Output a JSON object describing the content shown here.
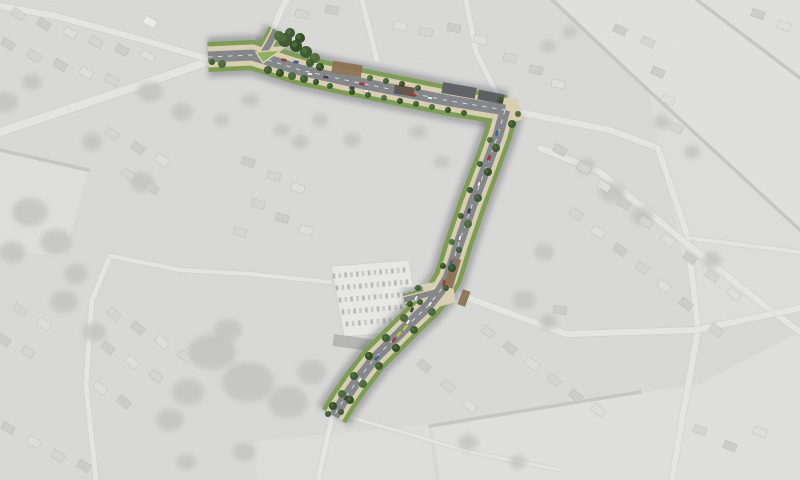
{
  "meta": {
    "description": "Greyscale aerial photograph of a village with a coloured landscape masterplan overlay of a proposed street corridor",
    "width": 800,
    "height": 480
  },
  "background": {
    "base": "#cfcfcd",
    "wash_color": "#ffffff",
    "wash_opacity": 0.26,
    "fields": [
      {
        "pts": "556,0 800,0 800,228 648,88",
        "fill": "#dadad8"
      },
      {
        "pts": "648,88 800,228 800,312 700,330 660,150",
        "fill": "#d6d6d4"
      },
      {
        "pts": "432,424 700,384 800,332 800,480 440,480",
        "fill": "#d9d9d7"
      },
      {
        "pts": "252,442 428,424 436,480 258,480",
        "fill": "#d6d6d4"
      },
      {
        "pts": "0,152 88,172 64,258 0,248",
        "fill": "#d8d8d6"
      }
    ],
    "hedges": [
      "M 552 0 L 646 88",
      "M 646 88 L 800 230",
      "M 697 0 L 800 78",
      "M 0 150 L 88 170",
      "M 430 426 L 640 392"
    ],
    "hedge_color": "#aeaeac",
    "roads": [
      {
        "d": "M 0 132 L 140 85 L 212 60",
        "w": 8
      },
      {
        "d": "M 212 60 L 150 42 L 56 16 L 0 6",
        "w": 6
      },
      {
        "d": "M 272 32 L 282 8 L 287 0",
        "w": 6
      },
      {
        "d": "M 362 0 L 377 60",
        "w": 5
      },
      {
        "d": "M 466 0 L 476 52 L 498 96",
        "w": 5
      },
      {
        "d": "M 518 112 L 610 130 L 658 148",
        "w": 6
      },
      {
        "d": "M 658 148 L 688 238 L 698 330 L 682 420 L 672 480",
        "w": 6
      },
      {
        "d": "M 540 148 L 600 172 L 680 238 L 760 302 L 800 332",
        "w": 6
      },
      {
        "d": "M 452 292 L 566 334 L 696 330 L 800 308",
        "w": 6
      },
      {
        "d": "M 688 238 L 800 252",
        "w": 4
      },
      {
        "d": "M 96 480 L 86 384 L 92 300 L 110 256",
        "w": 5
      },
      {
        "d": "M 110 256 L 180 270 L 250 274 L 330 282",
        "w": 4
      },
      {
        "d": "M 332 418 L 318 480",
        "w": 5
      },
      {
        "d": "M 340 414 L 470 452 L 560 470",
        "w": 3
      }
    ],
    "road_fill": "#e2e2e0",
    "road_casing": "#bdbdbb",
    "tree_blobs": [
      [
        212,
        352,
        24,
        18
      ],
      [
        248,
        382,
        26,
        20
      ],
      [
        288,
        402,
        20,
        16
      ],
      [
        312,
        372,
        15,
        12
      ],
      [
        228,
        330,
        14,
        11
      ],
      [
        188,
        392,
        16,
        13
      ],
      [
        170,
        420,
        14,
        11
      ],
      [
        30,
        212,
        18,
        14
      ],
      [
        56,
        242,
        16,
        13
      ],
      [
        12,
        252,
        13,
        11
      ],
      [
        76,
        274,
        12,
        10
      ],
      [
        150,
        92,
        13,
        10
      ],
      [
        182,
        112,
        11,
        9
      ],
      [
        142,
        182,
        12,
        10
      ],
      [
        92,
        142,
        10,
        9
      ],
      [
        612,
        192,
        13,
        10
      ],
      [
        642,
        216,
        11,
        9
      ],
      [
        586,
        166,
        9,
        8
      ],
      [
        544,
        252,
        10,
        8
      ],
      [
        524,
        300,
        12,
        9
      ],
      [
        548,
        322,
        9,
        8
      ],
      [
        662,
        122,
        8,
        7
      ],
      [
        692,
        152,
        8,
        7
      ],
      [
        712,
        260,
        9,
        8
      ],
      [
        468,
        442,
        10,
        8
      ],
      [
        518,
        462,
        8,
        7
      ],
      [
        244,
        452,
        12,
        9
      ],
      [
        186,
        462,
        10,
        8
      ],
      [
        64,
        302,
        14,
        11
      ],
      [
        94,
        332,
        12,
        9
      ],
      [
        6,
        102,
        12,
        10
      ],
      [
        32,
        82,
        10,
        8
      ],
      [
        418,
        132,
        9,
        7
      ],
      [
        442,
        162,
        8,
        6
      ],
      [
        548,
        46,
        8,
        6
      ],
      [
        570,
        32,
        7,
        6
      ],
      [
        352,
        140,
        9,
        7
      ],
      [
        320,
        120,
        8,
        6
      ],
      [
        250,
        100,
        9,
        7
      ],
      [
        222,
        120,
        8,
        6
      ],
      [
        282,
        130,
        8,
        6
      ],
      [
        300,
        142,
        9,
        7
      ]
    ],
    "blob_color": "#a7a7a5",
    "house_size": [
      13,
      8
    ],
    "house_fills": [
      "#c9c9c7",
      "#bcbcba",
      "#d8d8d6",
      "#ececea"
    ],
    "houses": [
      [
        18,
        14,
        32,
        0
      ],
      [
        44,
        24,
        32,
        1
      ],
      [
        70,
        33,
        30,
        2
      ],
      [
        96,
        42,
        30,
        0
      ],
      [
        122,
        50,
        28,
        1
      ],
      [
        148,
        56,
        28,
        2
      ],
      [
        8,
        44,
        32,
        1
      ],
      [
        34,
        56,
        30,
        0
      ],
      [
        60,
        65,
        30,
        1
      ],
      [
        86,
        73,
        28,
        2
      ],
      [
        112,
        80,
        28,
        0
      ],
      [
        150,
        22,
        30,
        3
      ],
      [
        302,
        14,
        10,
        0
      ],
      [
        332,
        10,
        10,
        1
      ],
      [
        400,
        26,
        10,
        2
      ],
      [
        426,
        32,
        10,
        0
      ],
      [
        454,
        28,
        10,
        1
      ],
      [
        480,
        40,
        12,
        2
      ],
      [
        510,
        58,
        12,
        0
      ],
      [
        536,
        70,
        12,
        1
      ],
      [
        558,
        84,
        12,
        2
      ],
      [
        648,
        42,
        25,
        0
      ],
      [
        658,
        72,
        25,
        1
      ],
      [
        668,
        100,
        25,
        2
      ],
      [
        676,
        128,
        25,
        0
      ],
      [
        758,
        14,
        20,
        1
      ],
      [
        784,
        26,
        20,
        2
      ],
      [
        620,
        30,
        25,
        1
      ],
      [
        112,
        134,
        35,
        0
      ],
      [
        138,
        148,
        35,
        1
      ],
      [
        162,
        160,
        33,
        2
      ],
      [
        128,
        174,
        33,
        0
      ],
      [
        152,
        188,
        33,
        1
      ],
      [
        248,
        162,
        15,
        1
      ],
      [
        274,
        176,
        15,
        0
      ],
      [
        298,
        188,
        15,
        2
      ],
      [
        258,
        204,
        15,
        0
      ],
      [
        282,
        218,
        15,
        1
      ],
      [
        306,
        230,
        15,
        2
      ],
      [
        240,
        232,
        15,
        0
      ],
      [
        560,
        150,
        30,
        1
      ],
      [
        584,
        168,
        30,
        0
      ],
      [
        604,
        186,
        32,
        2
      ],
      [
        624,
        204,
        32,
        1
      ],
      [
        646,
        222,
        34,
        0
      ],
      [
        668,
        240,
        34,
        2
      ],
      [
        690,
        258,
        36,
        1
      ],
      [
        712,
        276,
        36,
        0
      ],
      [
        734,
        294,
        38,
        2
      ],
      [
        576,
        214,
        32,
        0
      ],
      [
        598,
        232,
        32,
        2
      ],
      [
        620,
        250,
        34,
        1
      ],
      [
        642,
        268,
        34,
        0
      ],
      [
        664,
        286,
        36,
        2
      ],
      [
        686,
        304,
        36,
        1
      ],
      [
        716,
        330,
        38,
        0
      ],
      [
        560,
        310,
        10,
        1
      ],
      [
        488,
        332,
        40,
        0
      ],
      [
        510,
        348,
        40,
        1
      ],
      [
        532,
        364,
        40,
        2
      ],
      [
        554,
        380,
        40,
        0
      ],
      [
        576,
        396,
        38,
        1
      ],
      [
        598,
        410,
        38,
        2
      ],
      [
        700,
        430,
        20,
        0
      ],
      [
        730,
        446,
        20,
        1
      ],
      [
        760,
        432,
        20,
        2
      ],
      [
        424,
        366,
        40,
        1
      ],
      [
        448,
        386,
        40,
        0
      ],
      [
        470,
        406,
        40,
        2
      ],
      [
        114,
        314,
        40,
        0
      ],
      [
        138,
        328,
        40,
        1
      ],
      [
        162,
        342,
        40,
        2
      ],
      [
        184,
        356,
        40,
        0
      ],
      [
        108,
        348,
        40,
        1
      ],
      [
        132,
        362,
        40,
        2
      ],
      [
        156,
        376,
        40,
        0
      ],
      [
        100,
        388,
        40,
        2
      ],
      [
        124,
        402,
        40,
        1
      ],
      [
        20,
        310,
        35,
        0
      ],
      [
        44,
        324,
        35,
        2
      ],
      [
        4,
        340,
        35,
        1
      ],
      [
        28,
        352,
        35,
        0
      ],
      [
        8,
        428,
        30,
        1
      ],
      [
        34,
        442,
        30,
        2
      ],
      [
        58,
        456,
        30,
        0
      ],
      [
        84,
        466,
        30,
        1
      ]
    ]
  },
  "car_park": {
    "outline": "331,266 409,260 421,330 344,337",
    "fill": "#e6e6e4",
    "edge": "#c2c2c0",
    "row_car_size": [
      2.6,
      5
    ],
    "row_fills": [
      "#9b9b99",
      "#b7b7b5"
    ],
    "rows": [
      [
        334,
        276,
        404,
        270,
        13
      ],
      [
        337,
        288,
        407,
        282,
        13
      ],
      [
        340,
        300,
        410,
        294,
        13
      ],
      [
        343,
        312,
        413,
        306,
        13
      ],
      [
        347,
        324,
        415,
        318,
        12
      ]
    ],
    "structures": [
      [
        333,
        338,
        58,
        12,
        8,
        "#8f8f8d"
      ]
    ]
  },
  "corridor": {
    "colors": {
      "shadow": "#54565a",
      "green": "#7e9c55",
      "path": "#d8cfb2",
      "road": "#85878a",
      "centerline": "#f0f0ee",
      "island": "#8fb05e",
      "brown": "#8c7356"
    },
    "segments": [
      {
        "name": "main-street",
        "d": "M 208 57 L 252 55 L 300 70 L 350 81 L 400 91 L 450 101 L 505 110",
        "green": 30,
        "path": 21,
        "road": 11,
        "dash": true
      },
      {
        "name": "north-arm",
        "d": "M 262 56 L 270 42 L 276 30",
        "green": 16,
        "path": 10,
        "road": 6.5,
        "dash": false
      },
      {
        "name": "south-road",
        "d": "M 505 110 L 498 135 L 486 168 L 472 205 L 459 243 L 448 278 L 440 291 L 428 306 L 410 323 L 392 341 L 374 359 L 357 381 L 343 401 L 334 416",
        "green": 28,
        "path": 19,
        "road": 10.5,
        "dash": true
      },
      {
        "name": "car-park-arm",
        "d": "M 440 291 L 404 300",
        "green": 12,
        "path": 8,
        "road": 5.5,
        "dash": false
      }
    ],
    "plazas": [
      "488,96 518,99 523,120 497,124",
      "422,284 452,280 456,302 427,310",
      "250,48 287,46 262,66"
    ],
    "island": "256,52 281,50 263,63",
    "brown_patches": [
      [
        332,
        63,
        30,
        12,
        9
      ],
      [
        448,
        258,
        9,
        30,
        17
      ],
      [
        460,
        290,
        8,
        16,
        20
      ]
    ],
    "buildings": [
      [
        442,
        85,
        34,
        11,
        10,
        "#606266"
      ],
      [
        394,
        86,
        20,
        9,
        10,
        "#6b564c"
      ],
      [
        478,
        92,
        26,
        10,
        11,
        "#5d5f62"
      ]
    ],
    "tree_fills": [
      "#3f5c35",
      "#4d6c3e",
      "#335029"
    ],
    "trees": [
      [
        285,
        40,
        7,
        0
      ],
      [
        296,
        46,
        6,
        2
      ],
      [
        306,
        52,
        6,
        0
      ],
      [
        315,
        58,
        5,
        1
      ],
      [
        290,
        33,
        5,
        0
      ],
      [
        300,
        38,
        5,
        2
      ],
      [
        279,
        36,
        5,
        1
      ],
      [
        310,
        63,
        4,
        0
      ],
      [
        320,
        67,
        4,
        2
      ],
      [
        222,
        64,
        4,
        1
      ],
      [
        212,
        62,
        3,
        0
      ],
      [
        268,
        70,
        4,
        0
      ],
      [
        280,
        73,
        4,
        2
      ],
      [
        292,
        76,
        4,
        1
      ],
      [
        304,
        79,
        4,
        0
      ],
      [
        316,
        82,
        3,
        2
      ],
      [
        330,
        86,
        3,
        0
      ],
      [
        370,
        78,
        3,
        1
      ],
      [
        386,
        81,
        3,
        0
      ],
      [
        402,
        84,
        3,
        2
      ],
      [
        418,
        88,
        3,
        0
      ],
      [
        500,
        100,
        3,
        2
      ],
      [
        352,
        92,
        3,
        2
      ],
      [
        368,
        95,
        3,
        0
      ],
      [
        384,
        98,
        3,
        1
      ],
      [
        400,
        101,
        3,
        2
      ],
      [
        416,
        104,
        3,
        0
      ],
      [
        432,
        107,
        3,
        1
      ],
      [
        448,
        110,
        3,
        2
      ],
      [
        464,
        113,
        3,
        0
      ],
      [
        512,
        124,
        4,
        0
      ],
      [
        518,
        114,
        3,
        1
      ],
      [
        496,
        148,
        4,
        0
      ],
      [
        488,
        172,
        4,
        2
      ],
      [
        478,
        198,
        4,
        0
      ],
      [
        468,
        224,
        4,
        1
      ],
      [
        459,
        250,
        3,
        0
      ],
      [
        452,
        268,
        4,
        2
      ],
      [
        446,
        288,
        3,
        0
      ],
      [
        432,
        312,
        4,
        1
      ],
      [
        414,
        330,
        4,
        0
      ],
      [
        396,
        348,
        4,
        2
      ],
      [
        379,
        366,
        4,
        0
      ],
      [
        363,
        384,
        4,
        1
      ],
      [
        350,
        400,
        4,
        2
      ],
      [
        341,
        412,
        3,
        0
      ],
      [
        490,
        140,
        3,
        1
      ],
      [
        480,
        164,
        3,
        0
      ],
      [
        470,
        190,
        3,
        2
      ],
      [
        461,
        216,
        3,
        0
      ],
      [
        452,
        242,
        3,
        1
      ],
      [
        443,
        266,
        3,
        2
      ],
      [
        420,
        302,
        3,
        0
      ],
      [
        404,
        318,
        4,
        1
      ],
      [
        386,
        338,
        4,
        0
      ],
      [
        369,
        356,
        4,
        2
      ],
      [
        354,
        376,
        4,
        0
      ],
      [
        342,
        394,
        4,
        1
      ],
      [
        333,
        406,
        4,
        2
      ],
      [
        328,
        414,
        3,
        0
      ],
      [
        418,
        288,
        3,
        0
      ],
      [
        410,
        304,
        3,
        2
      ]
    ],
    "car_size": [
      5,
      2.4
    ],
    "car_colors": {
      "red": "#b23a30",
      "blue": "#3c66a4",
      "white": "#ebecec",
      "dark": "#3f4347"
    },
    "cars": [
      [
        284,
        60,
        8,
        "red"
      ],
      [
        296,
        62,
        8,
        "blue"
      ],
      [
        310,
        74,
        8,
        "white"
      ],
      [
        326,
        77,
        8,
        "dark"
      ],
      [
        352,
        88,
        8,
        "dark"
      ],
      [
        366,
        91,
        8,
        "white"
      ],
      [
        362,
        84,
        8,
        "red"
      ],
      [
        398,
        92,
        9,
        "blue"
      ],
      [
        414,
        95,
        9,
        "red"
      ],
      [
        430,
        98,
        9,
        "white"
      ],
      [
        497,
        133,
        105,
        "blue"
      ],
      [
        489,
        158,
        108,
        "red"
      ],
      [
        479,
        184,
        108,
        "white"
      ],
      [
        469,
        211,
        107,
        "dark"
      ],
      [
        460,
        238,
        105,
        "white"
      ],
      [
        451,
        263,
        103,
        "blue"
      ],
      [
        444,
        283,
        98,
        "red"
      ],
      [
        430,
        304,
        125,
        "white"
      ],
      [
        416,
        298,
        115,
        "white"
      ],
      [
        412,
        310,
        118,
        "dark"
      ],
      [
        408,
        322,
        122,
        "white"
      ],
      [
        394,
        340,
        128,
        "red"
      ],
      [
        377,
        358,
        127,
        "blue"
      ],
      [
        360,
        380,
        125,
        "white"
      ],
      [
        346,
        398,
        125,
        "dark"
      ]
    ],
    "lime_color": "#b6c83a",
    "lime_marks": [
      [
        399,
        334,
        128
      ],
      [
        405,
        328,
        128
      ]
    ]
  }
}
